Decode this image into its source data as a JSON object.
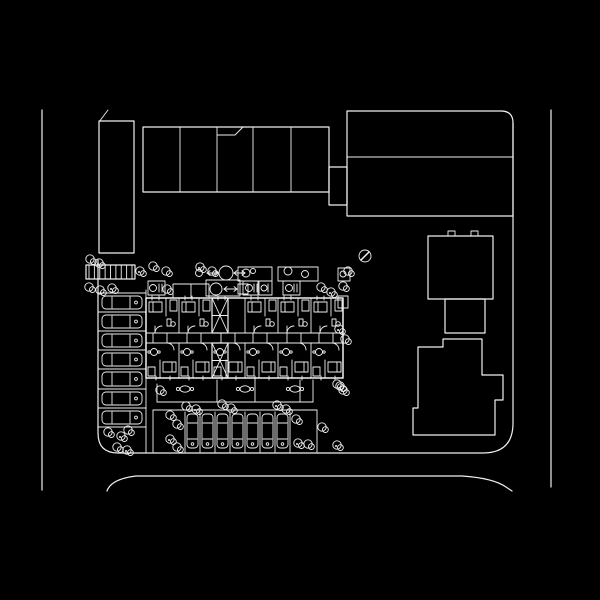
{
  "plan": {
    "canvas": {
      "w": 600,
      "h": 600
    },
    "colors": {
      "background": "#000000",
      "ink": "#f0f0f0"
    },
    "roads": [
      {
        "name": "west-road-curb",
        "d": "M42,110 L42,490"
      },
      {
        "name": "east-road-curb",
        "d": "M551,110 L551,487"
      },
      {
        "name": "south-road-curb",
        "d": "M107,491 Q111,479 136,476 L462,476 Q493,478 506,487 L512,491"
      }
    ],
    "parcel": {
      "d": "M513,123 L513,423 Q513,453 483,453 L118,453 Q98,453 98,433 L98,260"
    },
    "northwest_block": {
      "rect": [
        99,
        121,
        35,
        132
      ],
      "tick": "M99,122 L108,110"
    },
    "north_row": {
      "rect": [
        143,
        127,
        186,
        65
      ],
      "dividers_x": [
        180,
        217,
        253,
        291
      ],
      "notch": "M217,135 L235,135 L243,127"
    },
    "northeast_block": {
      "d": "M347,216 L347,111 L501,111 Q513,111 513,123 L513,216 Z",
      "divider_y": 157,
      "connector_rect": [
        329,
        167,
        18,
        38
      ]
    },
    "east_house": {
      "upper_rect": [
        428,
        236,
        65,
        63
      ],
      "top_tabs": [
        [
          448,
          231,
          7,
          5
        ],
        [
          471,
          231,
          7,
          5
        ]
      ],
      "mid_rect": [
        445,
        299,
        40,
        34
      ],
      "lower_d": "M418,347 L443,347 L443,339 L482,339 L482,375 L503,375 L503,400 L495,400 L495,435 L413,435 L413,408 L418,408 Z"
    },
    "apartment": {
      "outline": [
        146,
        298,
        197,
        80
      ],
      "corridor_y": [
        333,
        343
      ],
      "door_ticks_x": [
        153,
        167,
        187,
        201,
        221,
        235,
        253,
        267,
        287,
        301,
        319,
        333
      ],
      "unit_walls_x": [
        179,
        212,
        245,
        278,
        311
      ],
      "units_x": [
        146,
        179,
        212,
        245,
        278,
        311
      ],
      "core_unit_index": 2,
      "cores": [
        [
          212,
          298,
          16,
          35
        ],
        [
          212,
          343,
          16,
          35
        ]
      ],
      "projection": [
        173,
        284,
        36,
        14
      ]
    },
    "walkway": {
      "trellis_rect": [
        86,
        265,
        49,
        14
      ],
      "trellis_ticks": 9,
      "planters": [
        [
          238,
          267,
          34,
          14
        ],
        [
          278,
          267,
          40,
          14
        ]
      ],
      "planter_circles": [
        [
          246,
          273,
          4
        ],
        [
          253,
          271,
          2.5
        ],
        [
          288,
          271,
          4
        ],
        [
          305,
          274,
          3.5
        ]
      ],
      "fountain_upper": {
        "cx": 226,
        "cy": 273,
        "r": 7,
        "stem_cx": 199,
        "stem_cy": 273,
        "stem_r": 3.5,
        "arrow1": [
          207,
          273,
          218,
          273
        ],
        "arrow2": [
          234,
          273,
          245,
          273
        ]
      },
      "fountain_lower": {
        "cx": 216,
        "cy": 289,
        "r": 6,
        "arrow": [
          224,
          289,
          237,
          289
        ],
        "box": [
          238,
          284,
          10,
          10
        ]
      }
    },
    "balcony_boxes": [
      {
        "rect": [
          148,
          281,
          17,
          14
        ],
        "circle": [
          153,
          288,
          3.5
        ],
        "bars": [
          159,
          162
        ]
      },
      {
        "rect": [
          206,
          280,
          34,
          16
        ]
      },
      {
        "rect": [
          243,
          281,
          15,
          14
        ],
        "circle": [
          249,
          288,
          3.5
        ],
        "bars": [
          254,
          257
        ]
      },
      {
        "rect": [
          259,
          281,
          13,
          14
        ],
        "circle": [
          264,
          288,
          3
        ],
        "bars": [
          268
        ]
      },
      {
        "rect": [
          283,
          281,
          17,
          14
        ],
        "circle": [
          289,
          288,
          3.5
        ],
        "bars": [
          294,
          297
        ]
      },
      {
        "rect": [
          338,
          268,
          12,
          13
        ],
        "circle": [
          343,
          274,
          3
        ]
      },
      {
        "rect": [
          338,
          296,
          10,
          12
        ]
      }
    ],
    "patios": {
      "top_y": 380,
      "bottom_y": 402,
      "left_x": 157,
      "right_x": 313,
      "dividers_x": [
        217,
        255,
        300
      ],
      "tables": [
        [
          185,
          389
        ],
        [
          245,
          389
        ],
        [
          295,
          389
        ]
      ]
    },
    "parking_west": {
      "left": 98,
      "right": 146,
      "dividers_y": [
        293,
        312,
        331,
        350,
        369,
        389,
        408,
        427
      ],
      "car_x": 102,
      "car_w": 40
    },
    "parking_south": {
      "top": 410,
      "bottom": 452,
      "left": 153,
      "right": 317,
      "dividers_x": [
        185,
        200,
        215,
        230,
        245,
        260,
        275,
        290
      ],
      "car_y": 414,
      "car_h": 34
    },
    "utility_marker": {
      "cx": 365,
      "cy": 256,
      "r": 6,
      "slash": "M361,260 L369,252"
    },
    "trees": [
      [
        140,
        271
      ],
      [
        153,
        266
      ],
      [
        166,
        271
      ],
      [
        200,
        267
      ],
      [
        212,
        271
      ],
      [
        90,
        259
      ],
      [
        99,
        263
      ],
      [
        89,
        287
      ],
      [
        100,
        290
      ],
      [
        112,
        288
      ],
      [
        167,
        289
      ],
      [
        321,
        287
      ],
      [
        331,
        292
      ],
      [
        343,
        286
      ],
      [
        348,
        271
      ],
      [
        339,
        329
      ],
      [
        345,
        339
      ],
      [
        337,
        384
      ],
      [
        343,
        390
      ],
      [
        160,
        390
      ],
      [
        108,
        432
      ],
      [
        121,
        436
      ],
      [
        128,
        430
      ],
      [
        117,
        447
      ],
      [
        127,
        450
      ],
      [
        170,
        415
      ],
      [
        177,
        424
      ],
      [
        170,
        439
      ],
      [
        177,
        447
      ],
      [
        186,
        406
      ],
      [
        196,
        409
      ],
      [
        222,
        404
      ],
      [
        231,
        408
      ],
      [
        277,
        405
      ],
      [
        286,
        409
      ],
      [
        296,
        419
      ],
      [
        298,
        443
      ],
      [
        308,
        444
      ],
      [
        322,
        427
      ],
      [
        337,
        445
      ],
      [
        340,
        386
      ]
    ]
  }
}
